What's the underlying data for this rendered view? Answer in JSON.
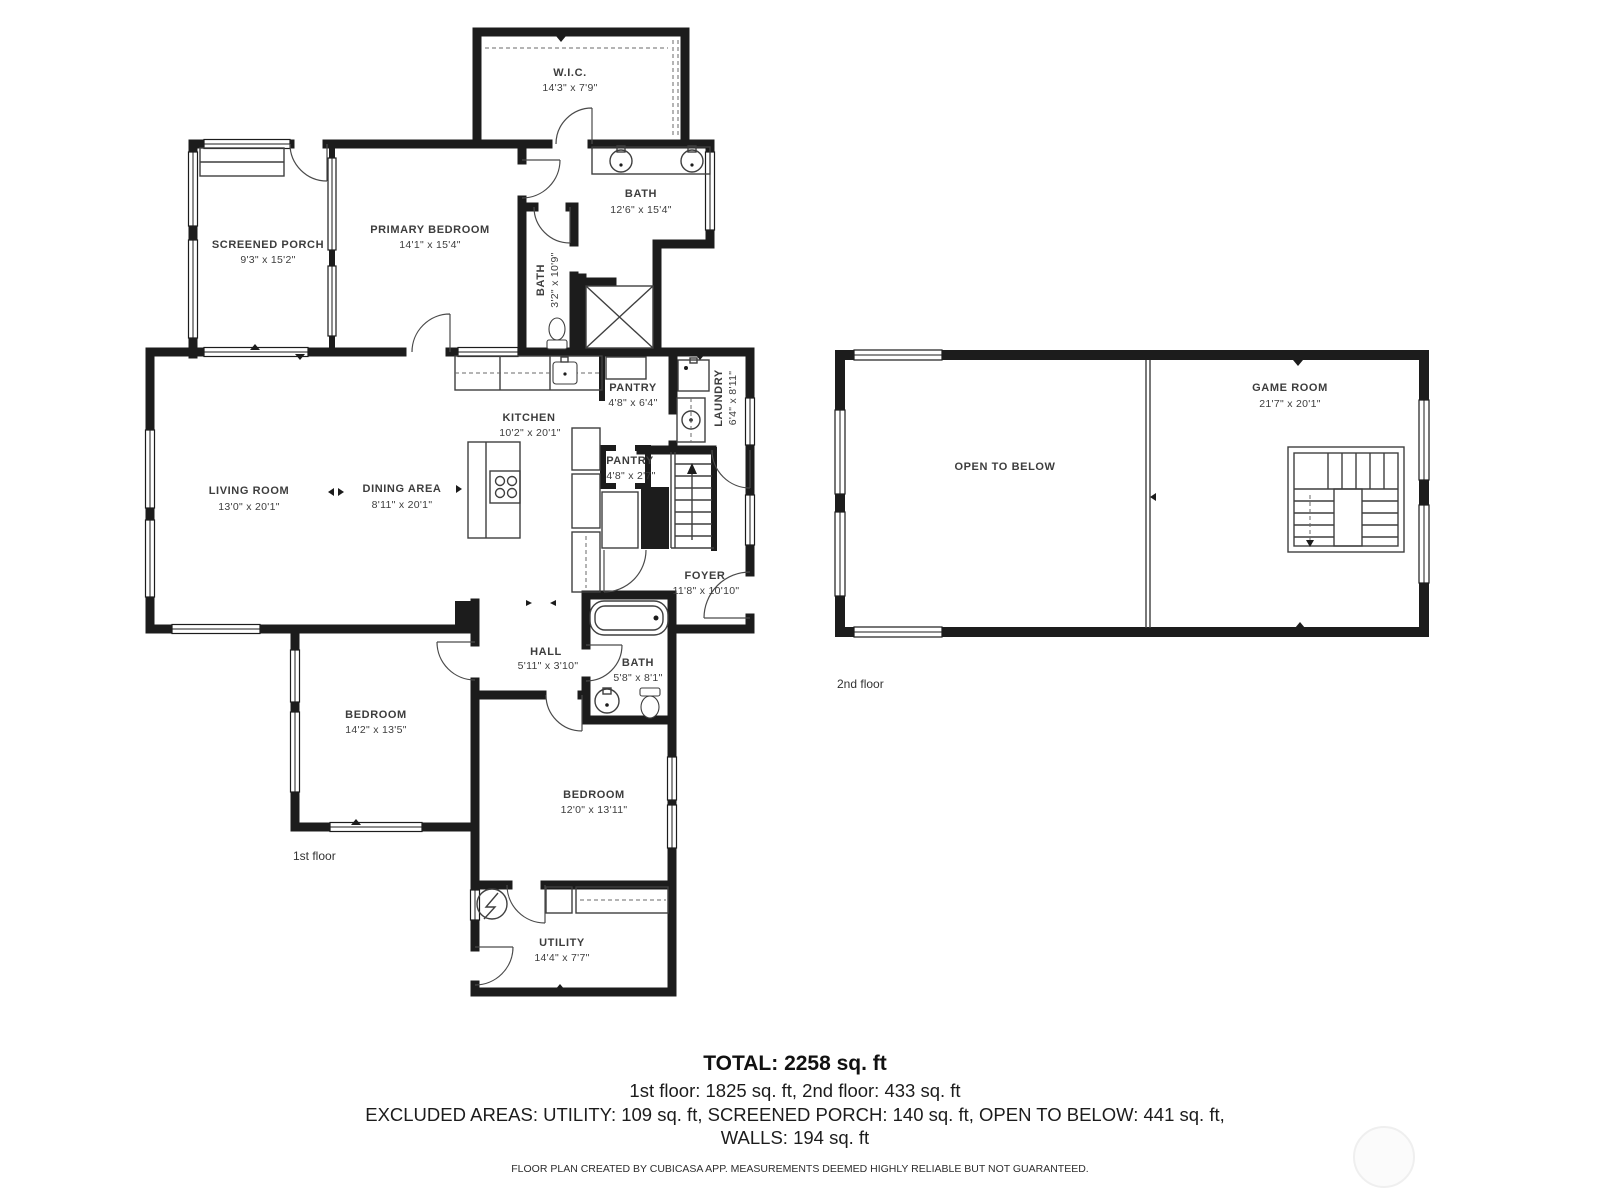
{
  "floor1": {
    "label": "1st floor",
    "rooms": {
      "wic": {
        "name": "W.I.C.",
        "dims": "14'3\" x 7'9\""
      },
      "screened_porch": {
        "name": "SCREENED PORCH",
        "dims": "9'3\" x 15'2\""
      },
      "primary_bedroom": {
        "name": "PRIMARY BEDROOM",
        "dims": "14'1\" x 15'4\""
      },
      "bath_primary": {
        "name": "BATH",
        "dims": "12'6\" x 15'4\""
      },
      "bath_small": {
        "name": "BATH",
        "dims": "3'2\" x 10'9\""
      },
      "kitchen": {
        "name": "KITCHEN",
        "dims": "10'2\" x 20'1\""
      },
      "pantry_upper": {
        "name": "PANTRY",
        "dims": "4'8\" x 6'4\""
      },
      "pantry_lower": {
        "name": "PANTRY",
        "dims": "4'8\" x 2'7\""
      },
      "laundry": {
        "name": "LAUNDRY",
        "dims": "6'4\" x 8'11\""
      },
      "living_room": {
        "name": "LIVING ROOM",
        "dims": "13'0\" x 20'1\""
      },
      "dining_area": {
        "name": "DINING AREA",
        "dims": "8'11\" x 20'1\""
      },
      "foyer": {
        "name": "FOYER",
        "dims": "11'8\" x 10'10\""
      },
      "hall": {
        "name": "HALL",
        "dims": "5'11\" x 3'10\""
      },
      "bath_hall": {
        "name": "BATH",
        "dims": "5'8\" x 8'1\""
      },
      "bedroom_left": {
        "name": "BEDROOM",
        "dims": "14'2\" x 13'5\""
      },
      "bedroom_right": {
        "name": "BEDROOM",
        "dims": "12'0\" x 13'11\""
      },
      "utility": {
        "name": "UTILITY",
        "dims": "14'4\" x 7'7\""
      }
    }
  },
  "floor2": {
    "label": "2nd floor",
    "rooms": {
      "open_to_below": {
        "name": "OPEN TO BELOW"
      },
      "game_room": {
        "name": "GAME ROOM",
        "dims": "21'7\" x 20'1\""
      }
    }
  },
  "summary": {
    "total": "TOTAL: 2258 sq. ft",
    "floors": "1st floor: 1825 sq. ft, 2nd floor: 433 sq. ft",
    "excluded": "EXCLUDED AREAS: UTILITY: 109 sq. ft, SCREENED PORCH: 140 sq. ft, OPEN TO BELOW: 441 sq. ft,",
    "walls": "WALLS: 194 sq. ft",
    "disclaimer": "FLOOR PLAN CREATED BY CUBICASA APP. MEASUREMENTS DEEMED HIGHLY RELIABLE BUT NOT GUARANTEED."
  },
  "colors": {
    "wall": "#1c1c1c",
    "label": "#3d3d3d",
    "background": "#ffffff"
  }
}
